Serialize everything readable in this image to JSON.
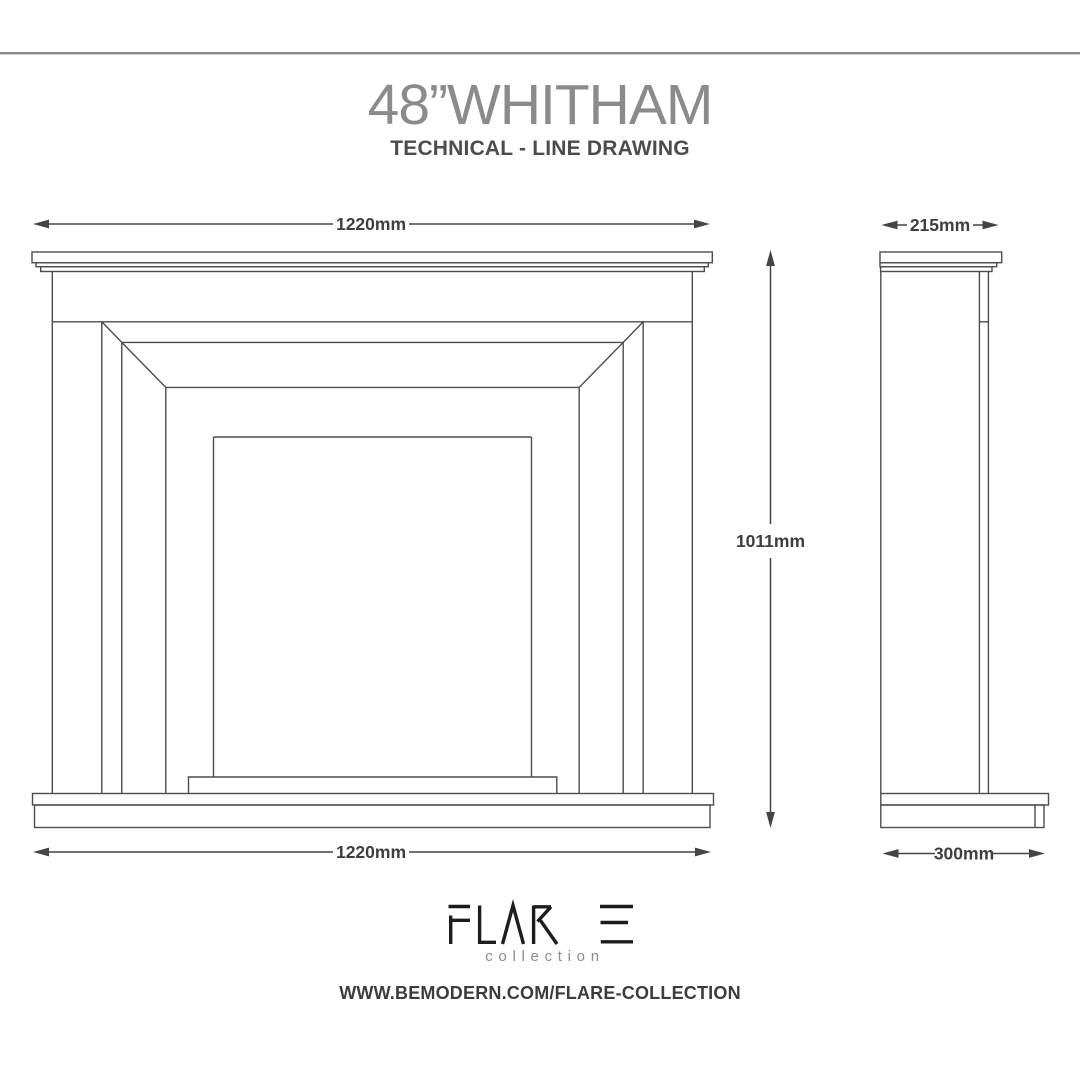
{
  "page": {
    "title": "48”WHITHAM",
    "subtitle": "TECHNICAL - LINE DRAWING"
  },
  "views": {
    "front": {
      "width_top": "1220mm",
      "width_bottom": "1220mm",
      "height": "1011mm"
    },
    "side": {
      "depth_top": "215mm",
      "depth_bottom": "300mm"
    }
  },
  "footer": {
    "brand": "FLARE",
    "brand_sub": "collection",
    "url": "WWW.BEMODERN.COM/FLARE-COLLECTION"
  },
  "colors": {
    "line": "#4d4d4d",
    "dimension_text": "#3e3e3e",
    "title": "#8b8b8b",
    "subtitle": "#4c4c4c",
    "logo": "#1d1d1d",
    "rule": "#8a8a8a"
  }
}
